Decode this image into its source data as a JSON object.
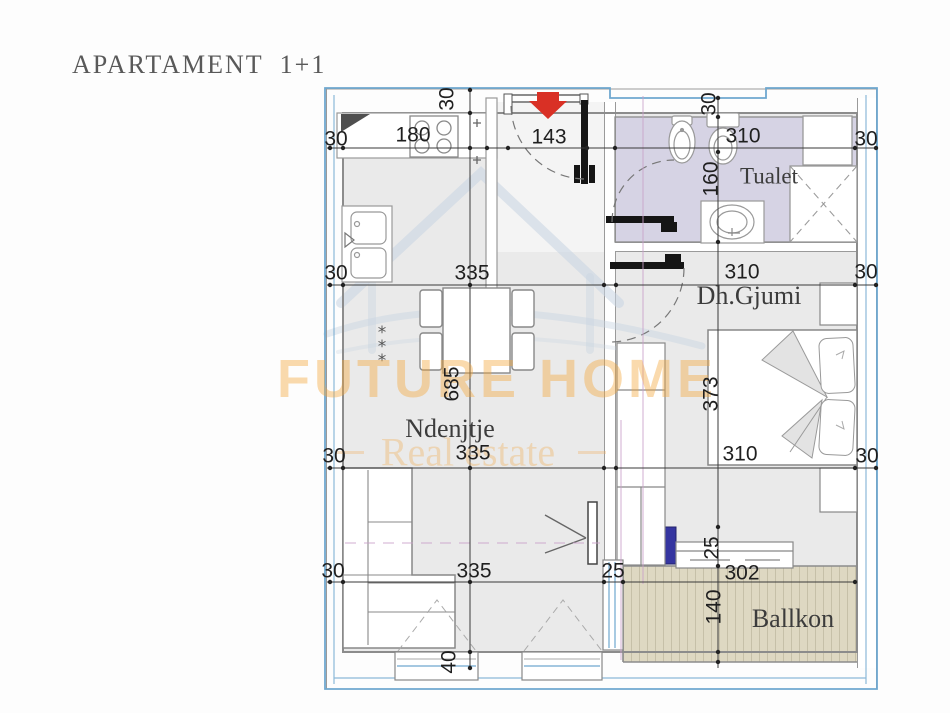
{
  "title": "APARTAMENT 1+1",
  "watermark": {
    "brand": "FUTURE HOME",
    "tagline": "Real estate"
  },
  "rooms": [
    {
      "id": "tualet",
      "label": "Tualet",
      "x": 769,
      "y": 176,
      "size": 23
    },
    {
      "id": "dhgjumi",
      "label": "Dh.Gjumi",
      "x": 749,
      "y": 296,
      "size": 26
    },
    {
      "id": "ndenjtje",
      "label": "Ndenjtje",
      "x": 450,
      "y": 429,
      "size": 26
    },
    {
      "id": "ballkon",
      "label": "Ballkon",
      "x": 793,
      "y": 619,
      "size": 26
    }
  ],
  "dims": [
    {
      "t": "30",
      "x": 336,
      "y": 139
    },
    {
      "t": "180",
      "x": 413,
      "y": 135
    },
    {
      "t": "143",
      "x": 549,
      "y": 137
    },
    {
      "t": "310",
      "x": 743,
      "y": 136
    },
    {
      "t": "30",
      "x": 866,
      "y": 139
    },
    {
      "t": "30",
      "x": 447,
      "y": 99,
      "rot": 1
    },
    {
      "t": "30",
      "x": 709,
      "y": 104,
      "rot": 1
    },
    {
      "t": "160",
      "x": 711,
      "y": 179,
      "rot": 1
    },
    {
      "t": "30",
      "x": 336,
      "y": 273
    },
    {
      "t": "335",
      "x": 472,
      "y": 273
    },
    {
      "t": "310",
      "x": 742,
      "y": 272
    },
    {
      "t": "30",
      "x": 866,
      "y": 272
    },
    {
      "t": "685",
      "x": 452,
      "y": 384,
      "rot": 1
    },
    {
      "t": "373",
      "x": 711,
      "y": 394,
      "rot": 1
    },
    {
      "t": "30",
      "x": 334,
      "y": 456
    },
    {
      "t": "335",
      "x": 473,
      "y": 453
    },
    {
      "t": "310",
      "x": 740,
      "y": 454
    },
    {
      "t": "30",
      "x": 867,
      "y": 456
    },
    {
      "t": "25",
      "x": 712,
      "y": 548,
      "rot": 1
    },
    {
      "t": "30",
      "x": 333,
      "y": 571
    },
    {
      "t": "335",
      "x": 474,
      "y": 571
    },
    {
      "t": "25",
      "x": 613,
      "y": 571
    },
    {
      "t": "302",
      "x": 742,
      "y": 573
    },
    {
      "t": "140",
      "x": 714,
      "y": 607,
      "rot": 1
    },
    {
      "t": "40",
      "x": 449,
      "y": 662,
      "rot": 1
    }
  ],
  "colors": {
    "boundary": "#6fa8cf",
    "room_floor": "#eaeaea",
    "bath_floor": "#d6d3e4",
    "balcony_floor": "#ded8c2",
    "accent_navy": "#3535a0",
    "arrow_red": "#d93025",
    "watermark_orange": "#f2a63c",
    "wall_gray": "#8c8c8c"
  }
}
